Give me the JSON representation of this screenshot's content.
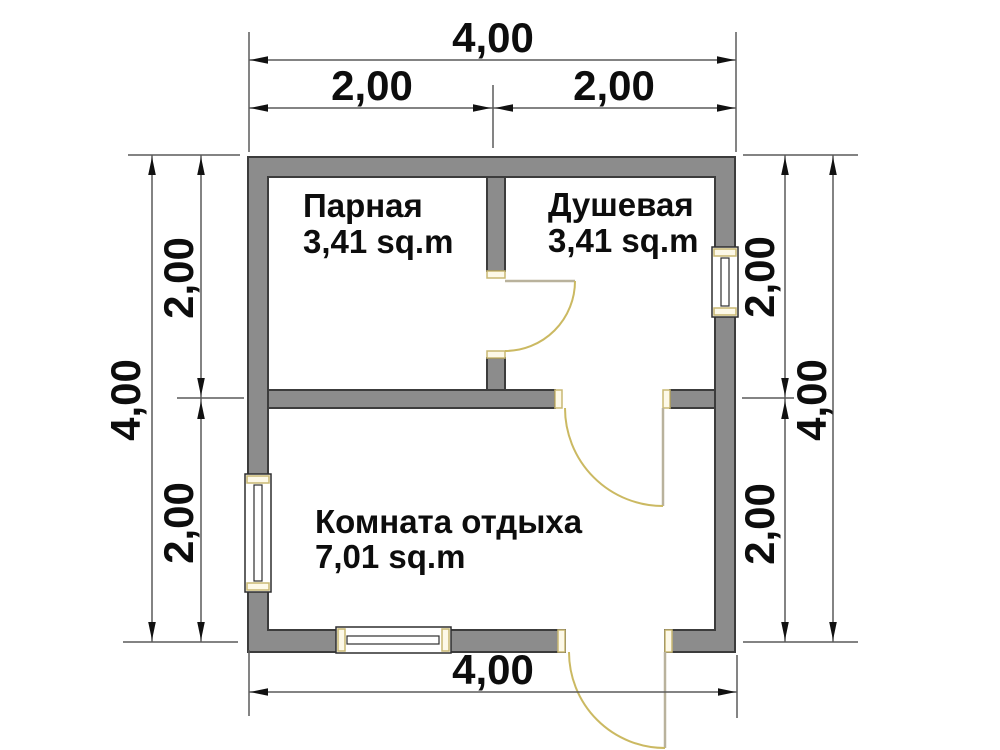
{
  "plan": {
    "rooms": [
      {
        "id": "parnaya",
        "name": "Парная",
        "area": "3,41 sq.m"
      },
      {
        "id": "dushevaya",
        "name": "Душевая",
        "area": "3,41 sq.m"
      },
      {
        "id": "komnata-otdyha",
        "name": "Комната отдыха",
        "area": "7,01 sq.m"
      }
    ],
    "dimensions": {
      "top_total": "4,00",
      "top_left": "2,00",
      "top_right": "2,00",
      "bottom_total": "4,00",
      "left_total": "4,00",
      "left_top": "2,00",
      "left_bottom": "2,00",
      "right_total": "4,00",
      "right_top": "2,00",
      "right_bottom": "2,00"
    }
  },
  "colors": {
    "background": "#ffffff",
    "wall_fill": "#8c8c8c",
    "wall_stroke": "#3c3c3c",
    "door": "#cbb962",
    "door_panel": "#b9b29c",
    "cap_fill": "#fdf9e8",
    "cap_stroke": "#c9b873",
    "window_stroke": "#2e2e2e",
    "dim_line": "#5a5a5a",
    "arrow": "#111111",
    "text_color": "#0d0d0d"
  }
}
